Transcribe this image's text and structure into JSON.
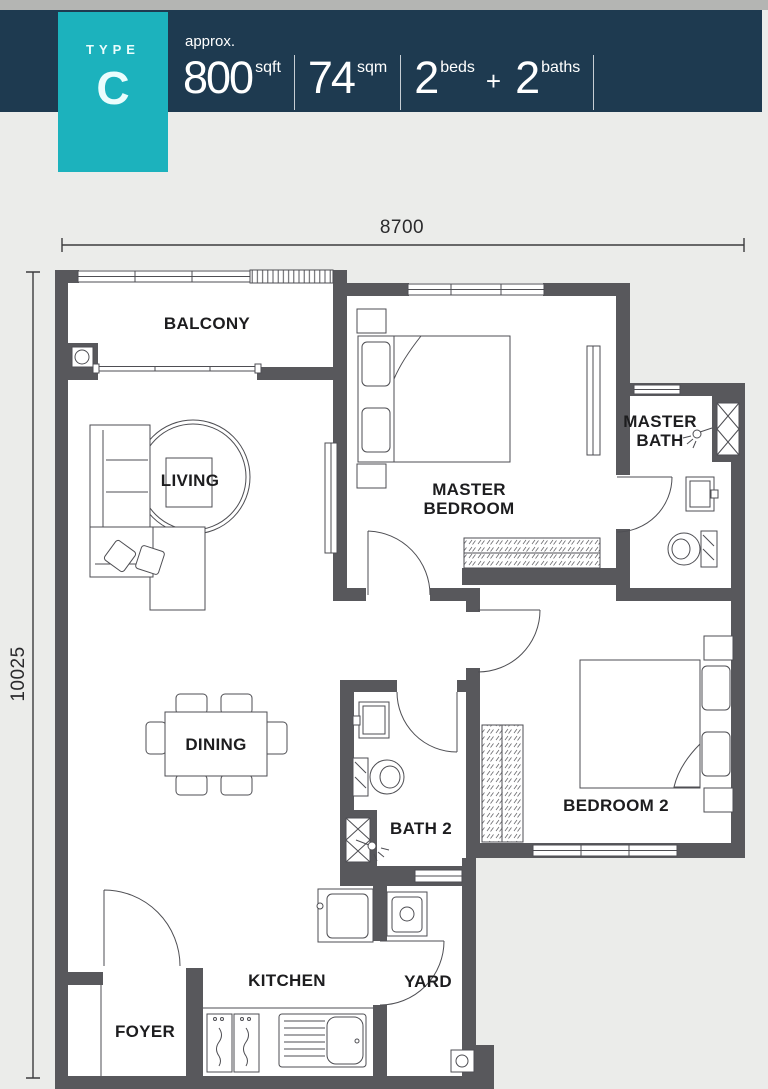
{
  "header": {
    "type_label": "TYPE",
    "type_value": "C",
    "approx_label": "approx.",
    "stats": [
      {
        "value": "800",
        "unit": "sqft"
      },
      {
        "value": "74",
        "unit": "sqm"
      },
      {
        "value": "2",
        "unit": "beds"
      },
      {
        "value": "2",
        "unit": "baths"
      }
    ],
    "plus_sign": "+",
    "colors": {
      "bar_navy": "#1e3a50",
      "tab_teal": "#1cb2bd",
      "top_strip": "#b4b5b3"
    }
  },
  "floor_plan": {
    "dimensions": {
      "width_mm": "8700",
      "height_mm": "10025"
    },
    "rooms": {
      "balcony": "BALCONY",
      "living": "LIVING",
      "master_bedroom": "MASTER BEDROOM",
      "master_bath": "MASTER BATH",
      "dining": "DINING",
      "bath2": "BATH 2",
      "bedroom2": "BEDROOM 2",
      "kitchen": "KITCHEN",
      "yard": "YARD",
      "foyer": "FOYER"
    },
    "colors": {
      "wall": "#58585c",
      "line": "#4e4e53",
      "floor": "#ffffff",
      "background": "#ebecea"
    }
  }
}
